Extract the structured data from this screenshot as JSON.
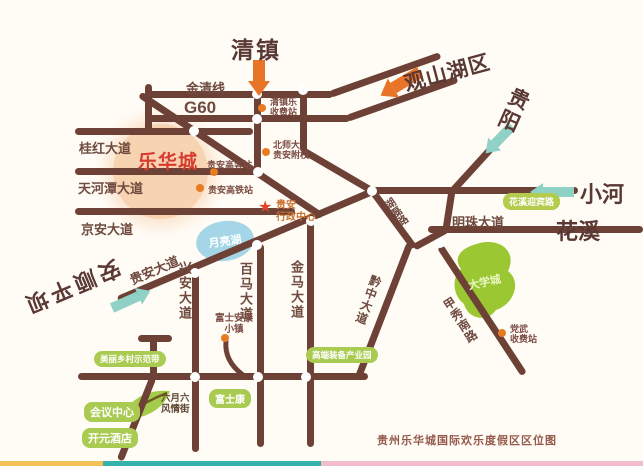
{
  "title": "贵州乐华城国际欢乐度假区区位图",
  "destinations": {
    "qingzhen": "清镇",
    "guanshanhuqu": "观山湖区",
    "guiyang": "贵阳",
    "xiaohe": "小河",
    "huaxi": "花溪",
    "anshun_pingba": "安顺平坝"
  },
  "roads": {
    "jinqingxian": "金清线",
    "g60": "G60",
    "guihong": "桂红大道",
    "tianhetan": "天河潭大道",
    "jingan": "京安大道",
    "guian": "贵安大道",
    "xingan": "兴安大道",
    "baima": "百马大道",
    "jinma": "金马大道",
    "qianzhong": "黔中大道",
    "jiaxiu": "甲秀南路",
    "mingzhu": "明珠大道",
    "hulei": "湖磊路"
  },
  "landmarks": {
    "lehuacheng": "乐华城",
    "yuelianghu": "月亮湖",
    "daxuecheng": "大学城",
    "admin": "贵安\n行政中心",
    "fushiankang": "富士安康\n小镇",
    "liuyueliu": "六月六\n风情街"
  },
  "stations": {
    "qingzhenle": "清镇乐\n收费站",
    "beishida": "北师大\n贵安附校",
    "gaokezhan": "贵安高客站",
    "gaotiezhan": "贵安高铁站",
    "dangwu": "党武\n收费站"
  },
  "badges": {
    "yingbin": "花溪迎宾路",
    "gaoduan": "高端装备产业园",
    "meili": "美丽乡村示范带",
    "fushikang": "富士康",
    "huiyi": "会议中心",
    "kaiyuan": "开元酒店"
  },
  "colors": {
    "road": "#6e4137",
    "arrow_orange": "#e87427",
    "arrow_teal": "#8fd2c5",
    "badge_green": "#a9cb52",
    "blob_green": "#9bc832",
    "lake_blue": "#a5d6e8",
    "lehua_red": "#d63b2f",
    "dest_brown": "#5a3833",
    "station_dot": "#e87a22",
    "caption": "#95594a",
    "circle_peach": "#f7cda6"
  }
}
